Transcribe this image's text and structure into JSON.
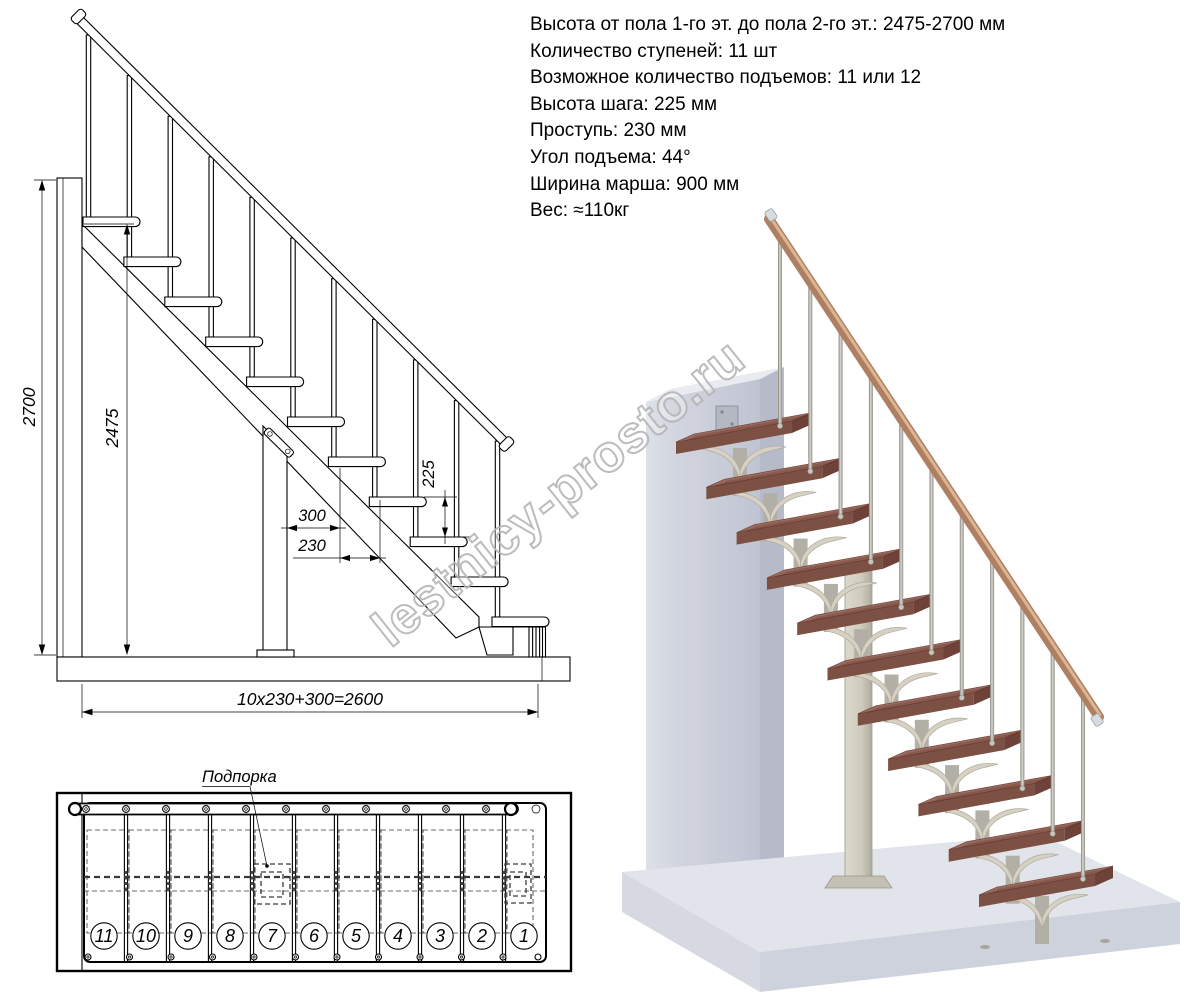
{
  "specs": {
    "lines": [
      "Высота от пола 1-го эт. до пола 2-го эт.: 2475-2700 мм",
      "Количество ступеней: 11 шт",
      "Возможное количество подъемов: 11 или 12",
      "Высота шага: 225 мм",
      "Проступь: 230 мм",
      "Угол подъема: 44°",
      "Ширина марша: 900 мм",
      "Вес: ≈110кг"
    ]
  },
  "side_view": {
    "dim_total_height": "2700",
    "dim_stair_height": "2475",
    "dim_riser": "225",
    "dim_first_tread": "300",
    "dim_tread": "230",
    "dim_total_run": "10x230+300=2600"
  },
  "plan_view": {
    "support_label": "Подпорка",
    "step_numbers": [
      "11",
      "10",
      "9",
      "8",
      "7",
      "6",
      "5",
      "4",
      "3",
      "2",
      "1"
    ]
  },
  "counts": {
    "steps": 11
  },
  "watermark": {
    "text": "lestnicy-prosto.ru"
  },
  "colors": {
    "step-top": "#9a6a5e",
    "step-front": "#7d5044",
    "step-side": "#6e4238",
    "rail-wood": "#ae7f60",
    "rail-light": "#dcb595",
    "metal-light": "#d8d6d0",
    "metal-dark": "#8f8c85",
    "bracket-beige": "#d6d1c3",
    "bracket-stem": "#b2afa6",
    "column": "#cfccbe",
    "wall-light": "#dde0e8",
    "wall-mid": "#c6cad6",
    "wall-dark": "#b7bbc9",
    "floor-top": "#e2e4eb",
    "floor-front": "#ced2dc",
    "watermark": "#b5b5b5"
  }
}
